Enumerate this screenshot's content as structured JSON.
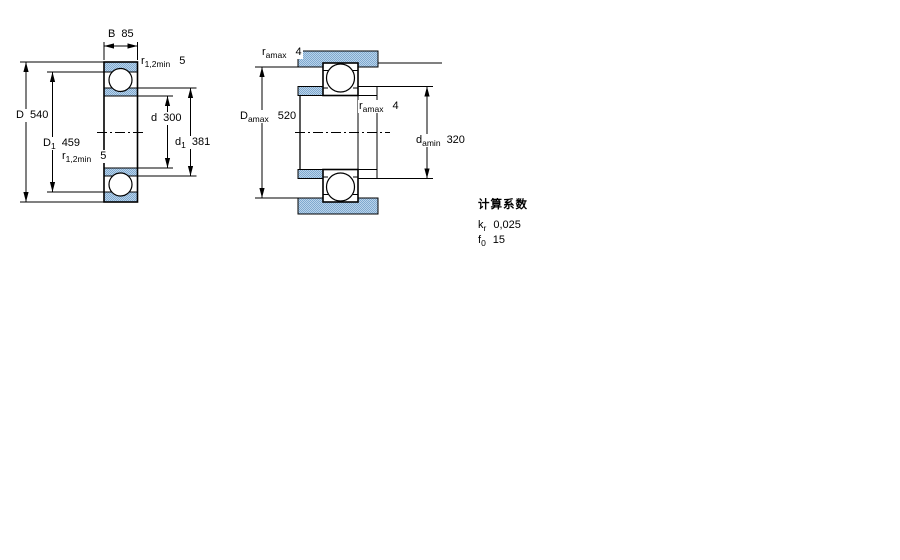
{
  "drawing": {
    "type": "bearing-technical-drawing",
    "views": {
      "cross_section": "deep groove ball bearing cross-section",
      "mounting": "abutment and fillet dimensions"
    }
  },
  "dims": {
    "B": {
      "name": "B",
      "sub": "",
      "value": "85"
    },
    "r_top": {
      "name": "r",
      "sub": "1,2min",
      "value": "5"
    },
    "D": {
      "name": "D",
      "sub": "",
      "value": "540"
    },
    "D1": {
      "name": "D",
      "sub": "1",
      "value": "459"
    },
    "r_bottom": {
      "name": "r",
      "sub": "1,2min",
      "value": "5"
    },
    "d": {
      "name": "d",
      "sub": "",
      "value": "300"
    },
    "d1": {
      "name": "d",
      "sub": "1",
      "value": "381"
    },
    "ramax_housing": {
      "name": "r",
      "sub": "amax",
      "value": "4"
    },
    "Damax": {
      "name": "D",
      "sub": "amax",
      "value": "520"
    },
    "ramax_shaft": {
      "name": "r",
      "sub": "amax",
      "value": "4"
    },
    "damin": {
      "name": "d",
      "sub": "amin",
      "value": "320"
    }
  },
  "calc_factors": {
    "heading": "计算系数",
    "rows": [
      {
        "name": "k",
        "sub": "r",
        "value": "0,025"
      },
      {
        "name": "f",
        "sub": "0",
        "value": "15"
      }
    ]
  },
  "colors": {
    "hatch_light": "#bad3ea",
    "hatch_dot": "#7fa9cf",
    "line": "#000000",
    "background": "#ffffff"
  }
}
